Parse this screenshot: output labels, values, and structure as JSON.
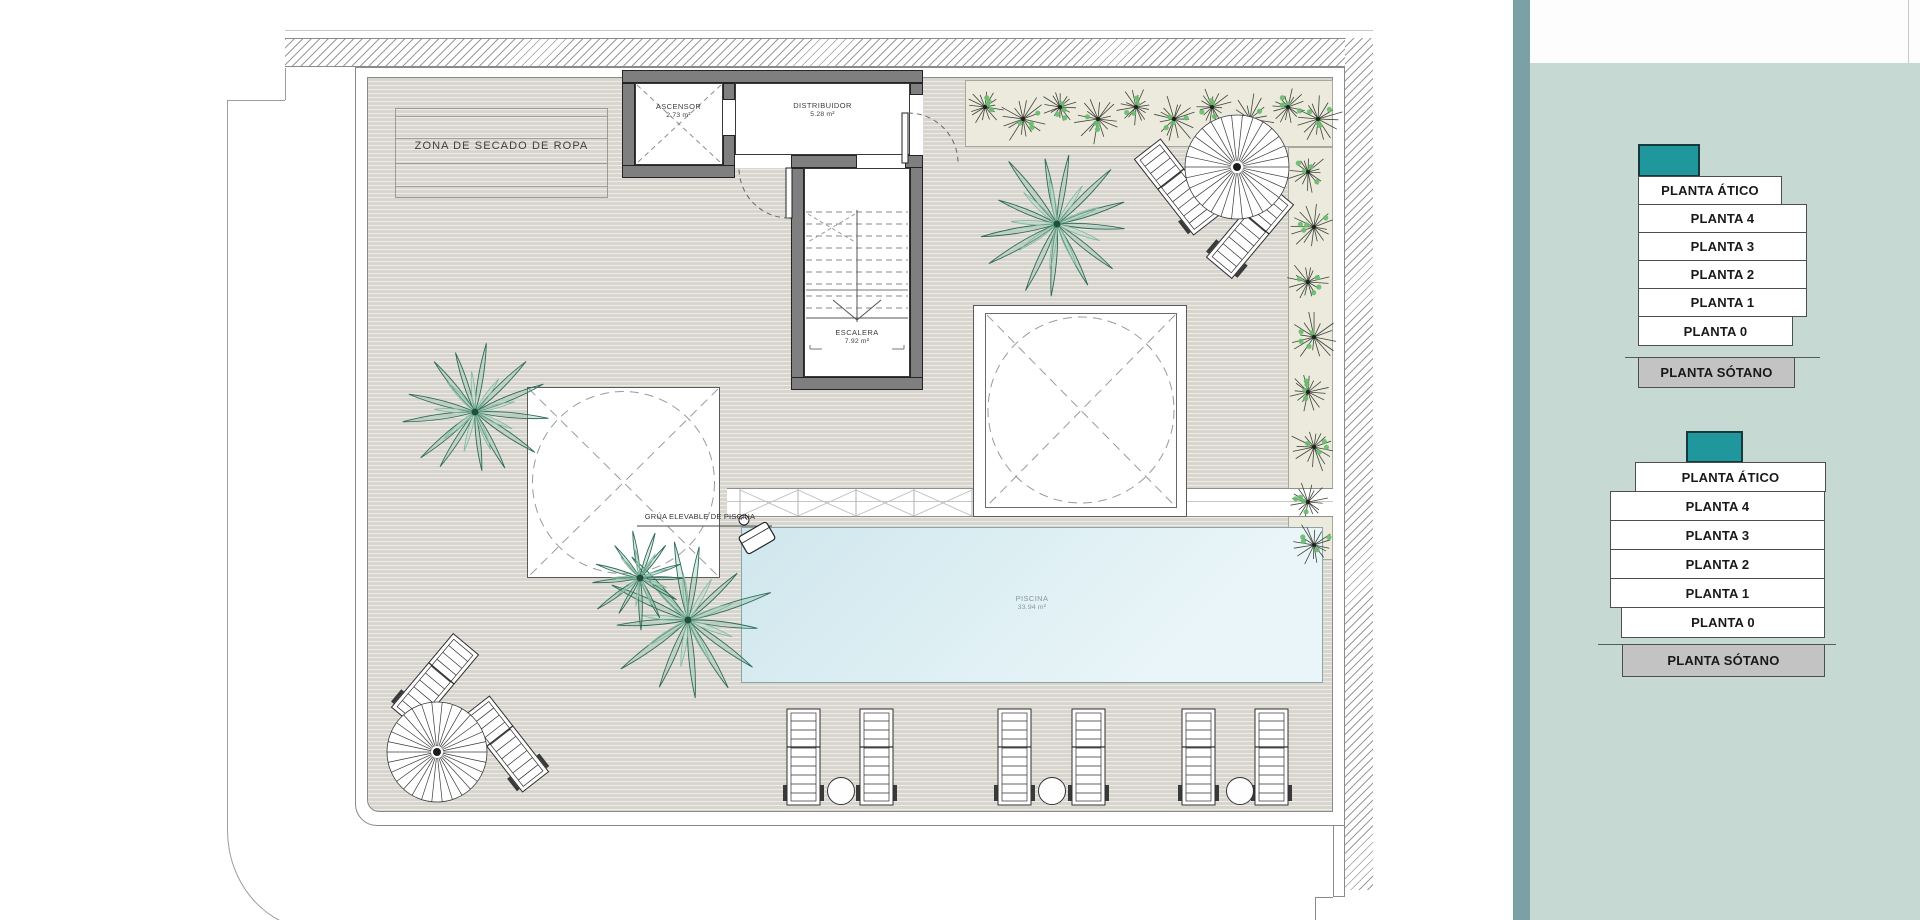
{
  "plan": {
    "zona_secado": "ZONA DE SECADO DE ROPA",
    "rooms": [
      {
        "name": "ASCENSOR",
        "area": "2.73 m²"
      },
      {
        "name": "DISTRIBUIDOR",
        "area": "5.28 m²"
      },
      {
        "name": "ESCALERA",
        "area": "7.92 m²"
      },
      {
        "name": "PISCINA",
        "area": "33.94 m²"
      }
    ],
    "annotations": {
      "grua": "GRÚA ELEVABLE DE PISCINA"
    }
  },
  "sidebar": {
    "panels": [
      {
        "id": "building-1",
        "floors": [
          "PLANTA ÁTICO",
          "PLANTA 4",
          "PLANTA 3",
          "PLANTA 2",
          "PLANTA 1",
          "PLANTA 0",
          "PLANTA SÓTANO"
        ]
      },
      {
        "id": "building-2",
        "floors": [
          "PLANTA ÁTICO",
          "PLANTA 4",
          "PLANTA 3",
          "PLANTA 2",
          "PLANTA 1",
          "PLANTA 0",
          "PLANTA SÓTANO"
        ]
      }
    ]
  },
  "colors": {
    "accent_teal": "#1f979d",
    "sidebar_bg": "#c6d9d2",
    "sidebar_strip": "#7ba1a7",
    "floor_button_bg": "#ffffff",
    "sotano_bg": "#c3c3c3",
    "pool": "#d8ebf0",
    "deck": "#d8d5ce"
  }
}
